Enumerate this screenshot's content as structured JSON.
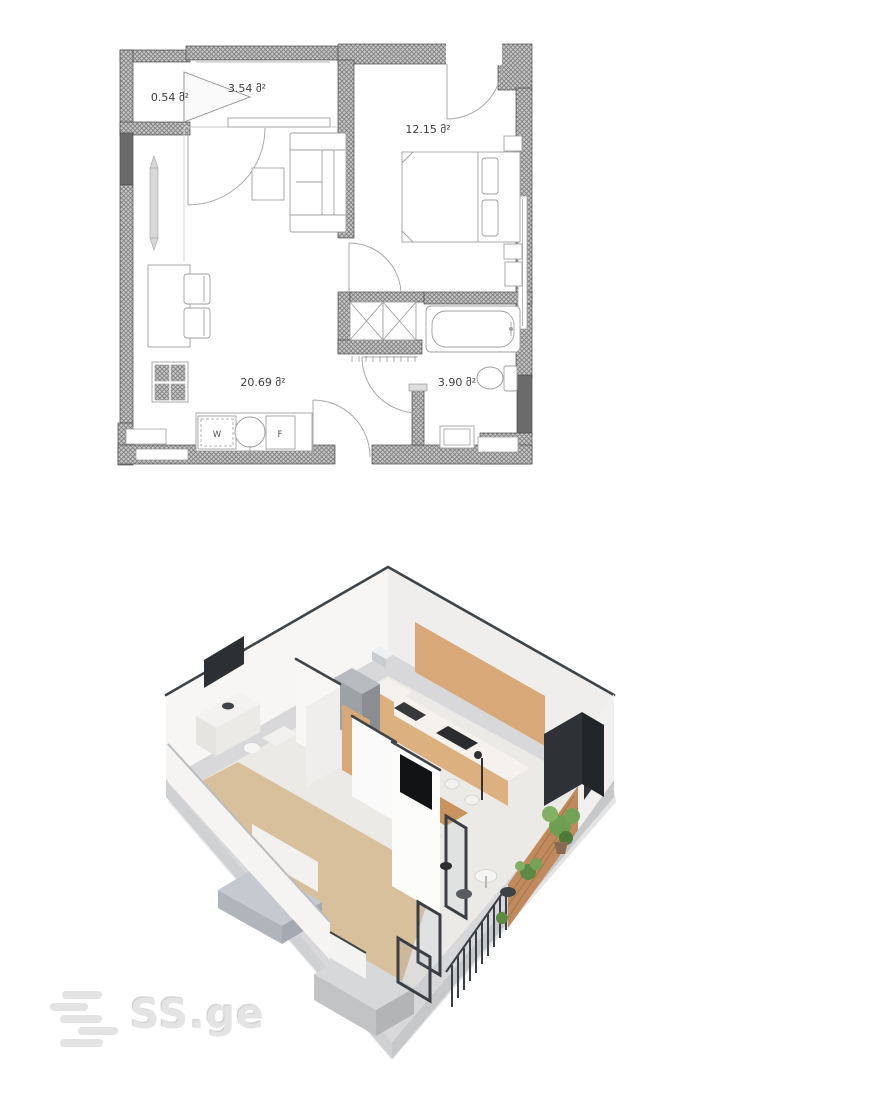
{
  "watermark": {
    "text": "SS.ge"
  },
  "floor_plan": {
    "area_unit": "მ²",
    "rooms": [
      {
        "name": "storage",
        "label": "0.54 მ²"
      },
      {
        "name": "hallway",
        "label": "3.54 მ²"
      },
      {
        "name": "bedroom",
        "label": "12.15 მ²"
      },
      {
        "name": "living-kitchen",
        "label": "20.69 მ²"
      },
      {
        "name": "bathroom",
        "label": "3.90 მ²"
      }
    ],
    "appliances": {
      "washer": "W",
      "fridge": "F"
    }
  },
  "colors": {
    "wall_hatch": "#c2c2c2",
    "wall_dark": "#6b6b6b",
    "wall_outline": "#4a4a4a",
    "furniture_line": "#9f9f9f",
    "label_text": "#3b3b3b",
    "wood_cabinet": "#d9a878",
    "wood_cabinet_light": "#ddb080",
    "wood_floor": "#d9c09c",
    "tile_floor": "#eceae6",
    "brick": "#c18a5e",
    "plant_green": "#6f9e52",
    "railing_dark": "#3a3f44",
    "slab_gray": "#c7c8ca",
    "accent_dark": "#2e3236",
    "bed_gray": "#c6cad0",
    "logo_gray": "#e4e4e4"
  }
}
